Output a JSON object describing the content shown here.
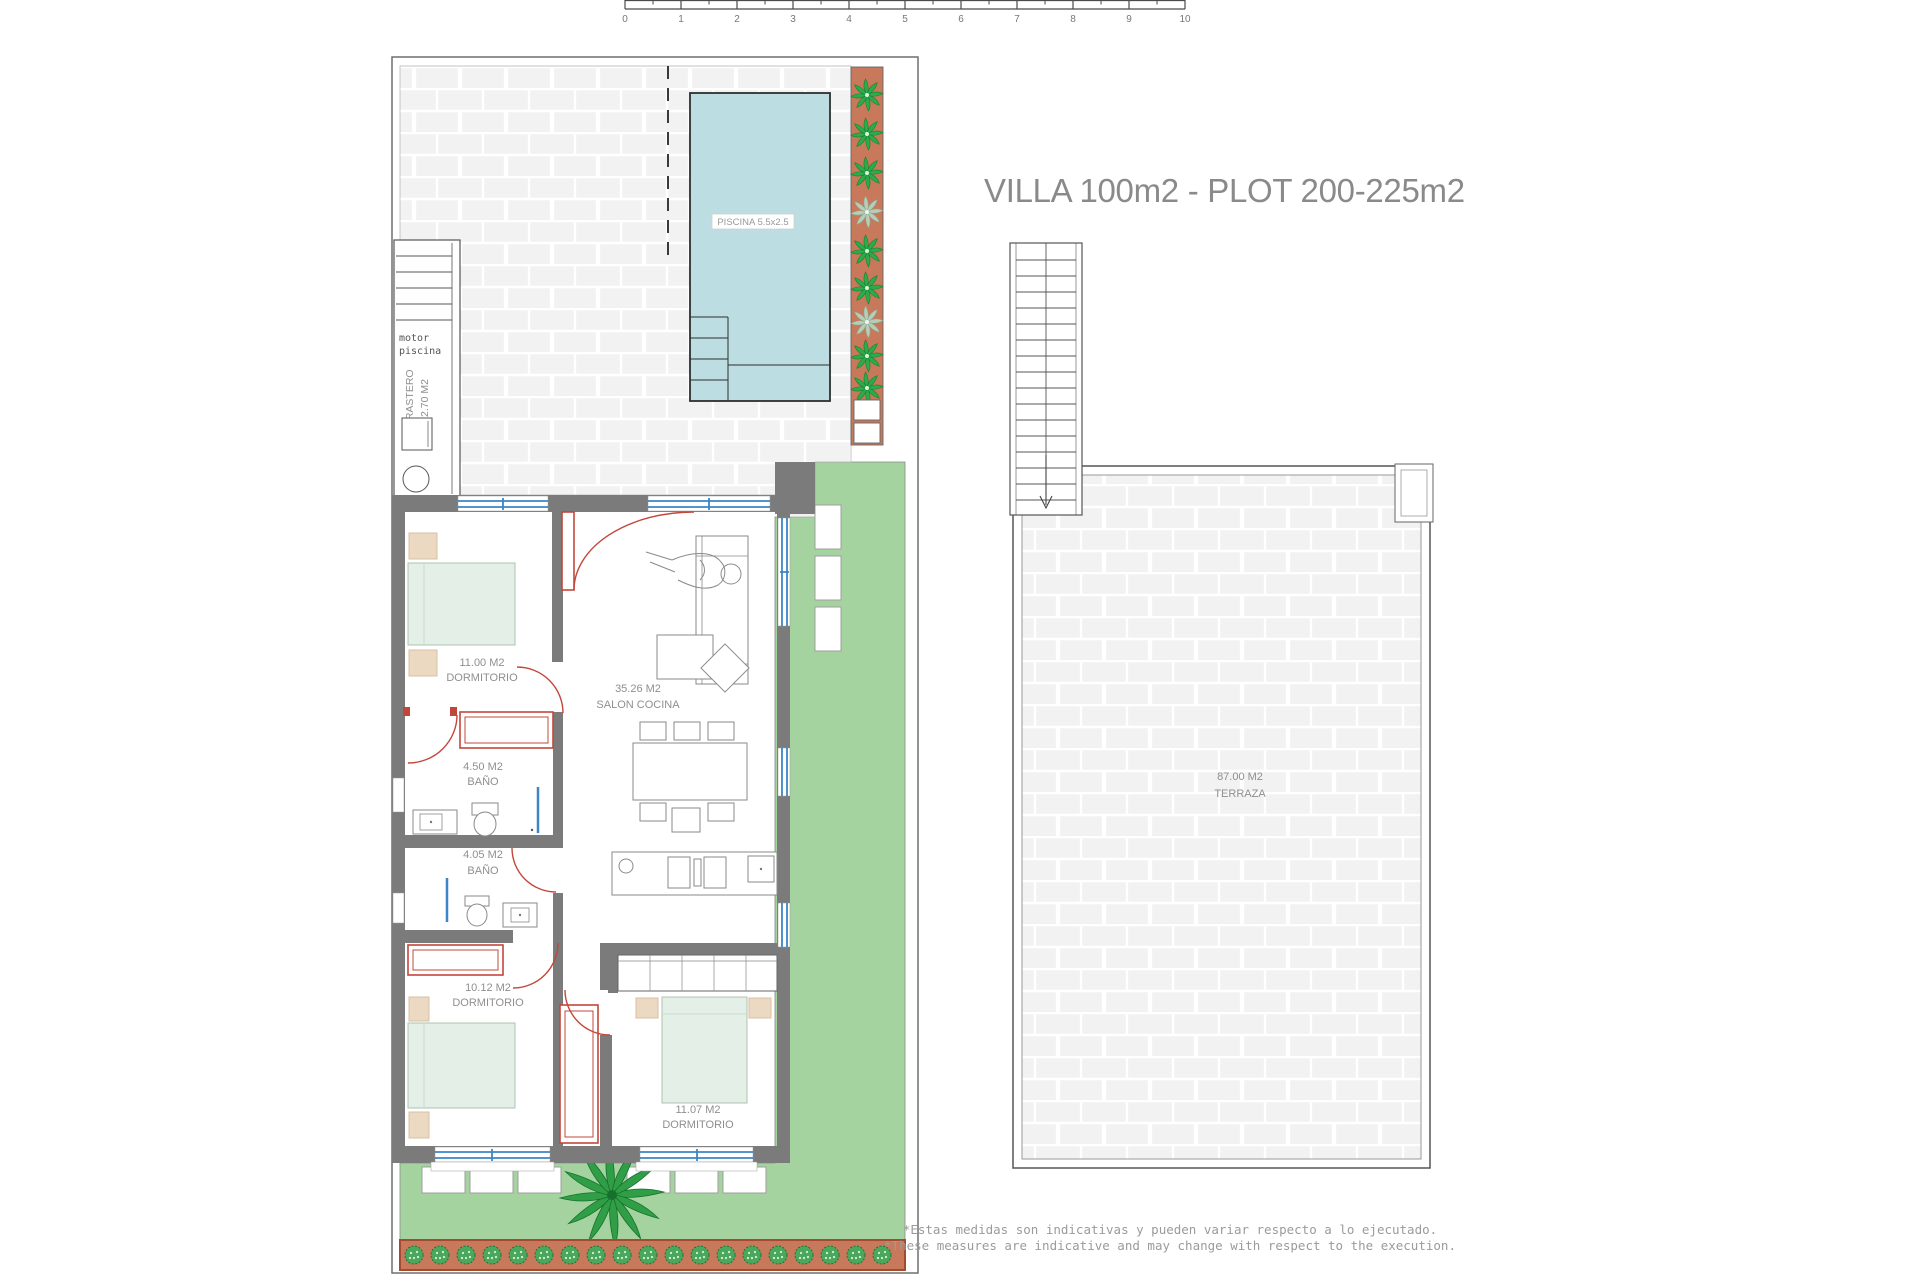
{
  "title": "VILLA 100m2 - PLOT 200-225m2",
  "scale_bar": {
    "ticks": [
      "0",
      "1",
      "2",
      "3",
      "4",
      "5",
      "6",
      "7",
      "8",
      "9",
      "10"
    ]
  },
  "site_plan": {
    "pool": {
      "label": "PISCINA 5.5x2.5"
    },
    "pool_motor": {
      "line1": "motor",
      "line2": "piscina"
    },
    "storage": {
      "name": "TRASTERO",
      "area": "2.70 M2"
    },
    "rooms": {
      "bedroom1": {
        "area": "11.00 M2",
        "name": "DORMITORIO"
      },
      "living": {
        "area": "35.26 M2",
        "name": "SALON COCINA"
      },
      "bath1": {
        "area": "4.50 M2",
        "name": "BAÑO"
      },
      "bath2": {
        "area": "4.05 M2",
        "name": "BAÑO"
      },
      "bedroom2": {
        "area": "10.12 M2",
        "name": "DORMITORIO"
      },
      "bedroom3": {
        "area": "11.07 M2",
        "name": "DORMITORIO"
      }
    }
  },
  "roof_plan": {
    "terrace": {
      "area": "87.00 M2",
      "name": "TERRAZA"
    }
  },
  "disclaimer": {
    "line1": "*Estas medidas son indicativas y pueden variar respecto a lo ejecutado.",
    "line2": "*These measures are indicative and may change with respect to the execution."
  },
  "colors": {
    "pool": "#bcdee2",
    "garden": "#a4d3a0",
    "planter": "#c8795b",
    "wall": "#7b7b7b",
    "door": "#c2473b",
    "window": "#3c85c6",
    "paving": "#f2f2f2",
    "label": "#8f8f8f"
  }
}
